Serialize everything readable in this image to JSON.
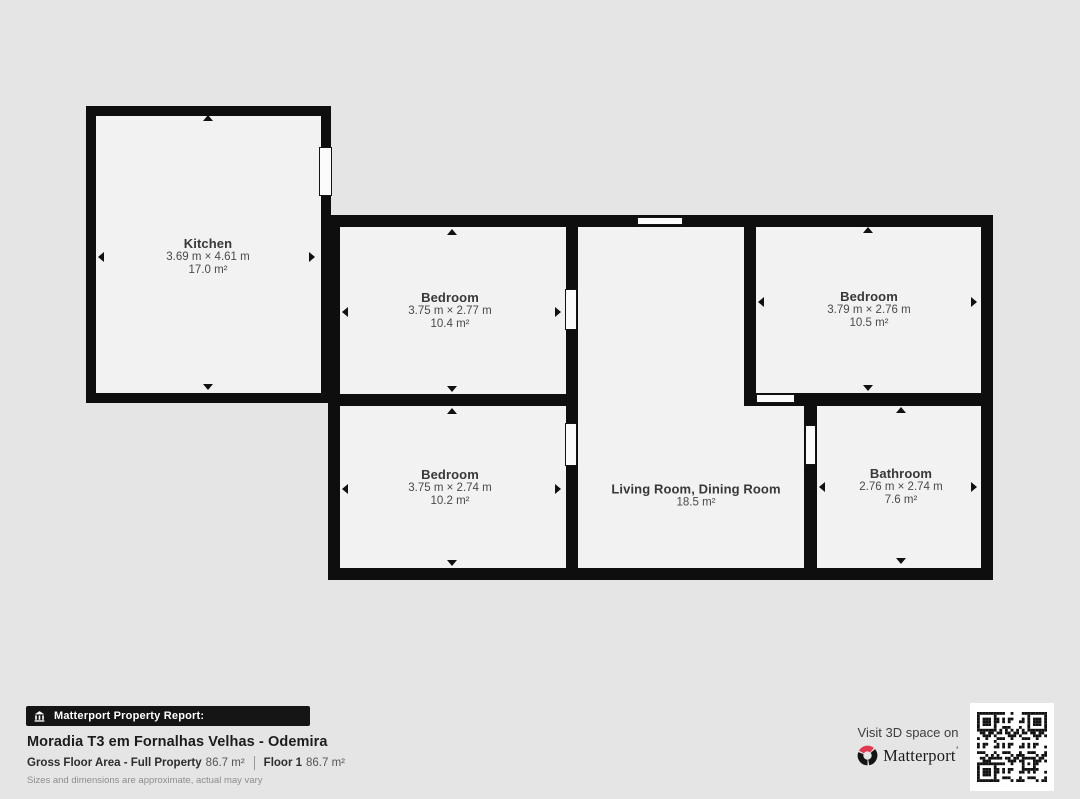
{
  "plan": {
    "wall_color": "#0e0e0e",
    "floor_color": "#f2f2f2",
    "background_color": "#e5e5e5",
    "rooms": [
      {
        "name": "Kitchen",
        "dims": "3.69 m × 4.61 m",
        "area": "17.0 m²"
      },
      {
        "name": "Bedroom",
        "dims": "3.75 m × 2.77 m",
        "area": "10.4 m²"
      },
      {
        "name": "Bedroom",
        "dims": "3.79 m × 2.76 m",
        "area": "10.5 m²"
      },
      {
        "name": "Bedroom",
        "dims": "3.75 m × 2.74 m",
        "area": "10.2 m²"
      },
      {
        "name": "Living Room, Dining Room",
        "dims": "",
        "area": "18.5 m²"
      },
      {
        "name": "Bathroom",
        "dims": "2.76 m × 2.74 m",
        "area": "7.6 m²"
      }
    ]
  },
  "report": {
    "badge_label": "Matterport Property Report:",
    "title": "Moradia T3 em Fornalhas Velhas - Odemira",
    "gross_label": "Gross Floor Area - Full Property",
    "gross_value": "86.7 m²",
    "floor_label": "Floor 1",
    "floor_value": "86.7 m²",
    "disclaimer": "Sizes and dimensions are approximate, actual may vary"
  },
  "promo": {
    "visit_text": "Visit 3D space on",
    "brand": "Matterport",
    "brand_mark": "’"
  },
  "icons": {
    "badge": "building-icon",
    "brand": "matterport-pinwheel-icon",
    "qr": "qr-code"
  },
  "colors": {
    "brand_red": "#e03a52",
    "badge_background": "#151515"
  }
}
